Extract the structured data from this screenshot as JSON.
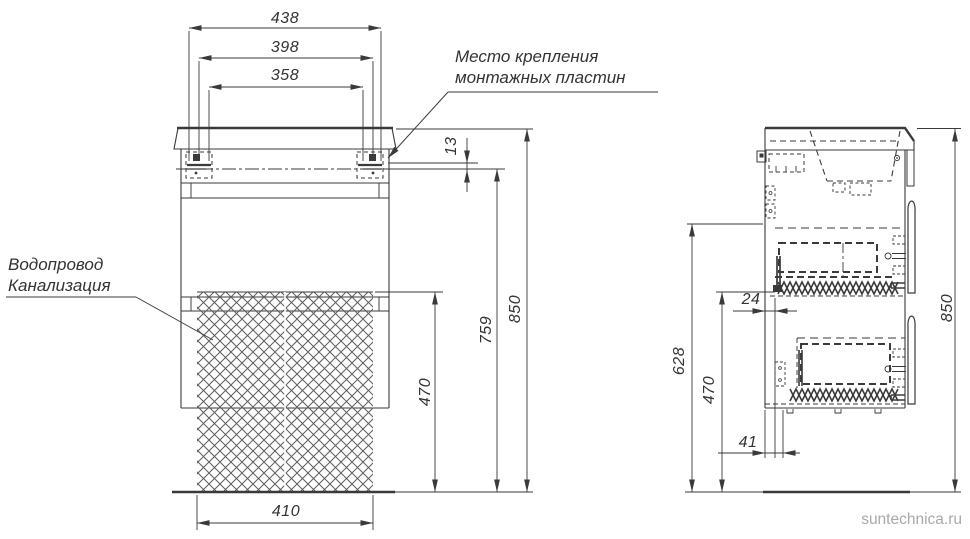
{
  "front_view": {
    "dim_width_outer": "438",
    "dim_width_mid": "398",
    "dim_width_inner": "358",
    "dim_plate_offset": "13",
    "dim_height_total": "850",
    "dim_height_plate": "759",
    "dim_height_clearance": "470",
    "dim_width_bottom": "410",
    "note_mounting_line1": "Место крепления",
    "note_mounting_line2": "монтажных пластин",
    "note_plumbing_line1": "Водопровод",
    "note_plumbing_line2": "Канализация"
  },
  "side_view": {
    "dim_back_offset": "24",
    "dim_height_upper": "628",
    "dim_height_clearance": "470",
    "dim_height_total": "850",
    "dim_bottom_offset": "41"
  },
  "watermark": "suntechnica.ru",
  "colors": {
    "line": "#3a3a3a",
    "watermark": "#a9a9a9",
    "background": "#ffffff"
  }
}
